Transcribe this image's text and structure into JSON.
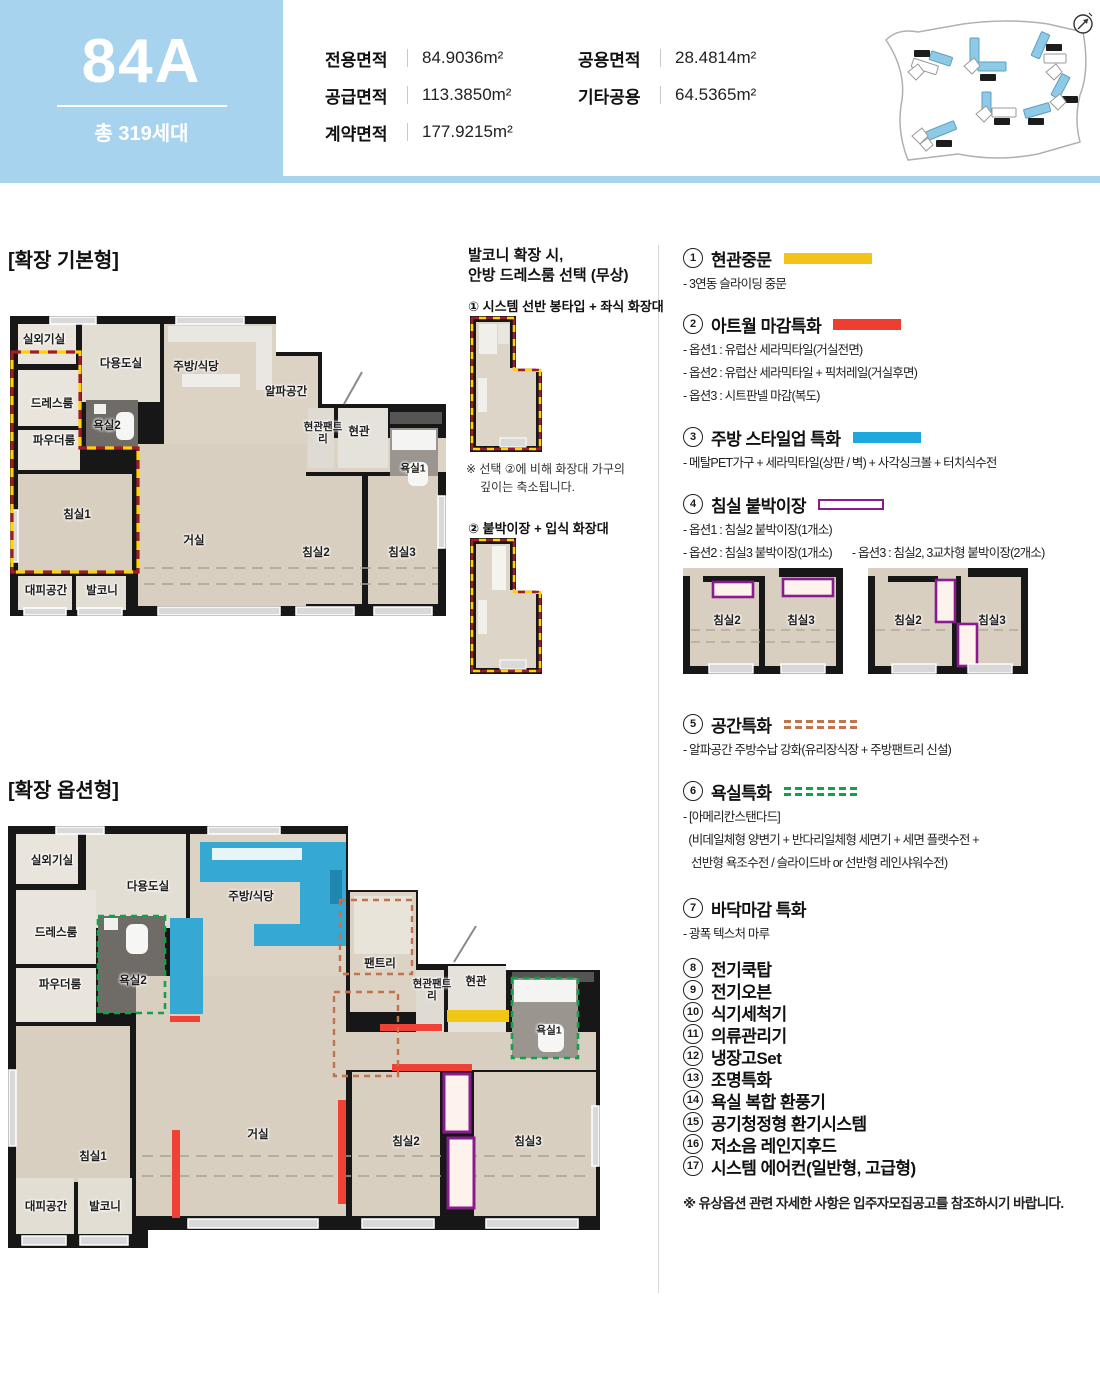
{
  "header": {
    "unit_type": "84A",
    "total_units": "총 319세대",
    "areas": [
      {
        "label": "전용면적",
        "value": "84.9036m²"
      },
      {
        "label": "공급면적",
        "value": "113.3850m²"
      },
      {
        "label": "계약면적",
        "value": "177.9215m²"
      },
      {
        "label": "공용면적",
        "value": "28.4814m²"
      },
      {
        "label": "기타공용",
        "value": "64.5365m²"
      }
    ]
  },
  "plans": {
    "basic": {
      "title": "[확장 기본형]",
      "rooms": [
        "실외기실",
        "다용도실",
        "주방/식당",
        "알파공간",
        "드레스룸",
        "욕실2",
        "파우더룸",
        "현관팬트리",
        "현관",
        "욕실1",
        "침실1",
        "거실",
        "침실2",
        "침실3",
        "대피공간",
        "발코니"
      ]
    },
    "option": {
      "title": "[확장 옵션형]",
      "rooms": [
        "실외기실",
        "다용도실",
        "주방/식당",
        "팬트리",
        "드레스룸",
        "욕실2",
        "파우더룸",
        "현관팬트리",
        "현관",
        "욕실1",
        "침실1",
        "거실",
        "침실2",
        "침실3",
        "대피공간",
        "발코니"
      ]
    }
  },
  "dressroom_choice": {
    "title_line1": "발코니 확장 시,",
    "title_line2": "안방 드레스룸 선택 (무상)",
    "option1": "① 시스템 선반 봉타입 + 좌식 화장대",
    "note_line1": "※ 선택 ②에 비해 화장대 가구의",
    "note_line2": "깊이는 축소됩니다.",
    "option2": "② 붙박이장 + 입식 화장대"
  },
  "features": {
    "items": [
      {
        "num": "1",
        "title": "현관중문",
        "legend": "yellow",
        "rows": [
          [
            "- 3연동 슬라이딩 중문"
          ]
        ]
      },
      {
        "num": "2",
        "title": "아트월 마감특화",
        "legend": "red",
        "rows": [
          [
            "- 옵션1 : 유럽산 세라믹타일(거실전면)"
          ],
          [
            "- 옵션2 : 유럽산 세라믹타일 + 픽처레일(거실후면)"
          ],
          [
            "- 옵션3 : 시트판넬 마감(복도)"
          ]
        ]
      },
      {
        "num": "3",
        "title": "주방 스타일업 특화",
        "legend": "blue",
        "rows": [
          [
            "- 메탈PET가구 + 세라믹타일(상판 / 벽) + 사각싱크볼 + 터치식수전"
          ]
        ]
      },
      {
        "num": "4",
        "title": "침실 붙박이장",
        "legend": "purple-outline",
        "rows": [
          [
            "- 옵션1 : 침실2 붙박이장(1개소)"
          ],
          [
            "- 옵션2 : 침실3 붙박이장(1개소)",
            "- 옵션3 : 침실2, 3교차형 붙박이장(2개소)"
          ]
        ]
      },
      {
        "num": "5",
        "title": "공간특화",
        "legend": "orange-dash",
        "rows": [
          [
            "- 알파공간 주방수납 강화(유리장식장 + 주방팬트리 신설)"
          ]
        ]
      },
      {
        "num": "6",
        "title": "욕실특화",
        "legend": "green-dash",
        "rows": [
          [
            "- [아메리칸스탠다드]"
          ],
          [
            "  (비데일체형 양변기 + 반다리일체형 세면기 + 세면 플랫수전 +"
          ],
          [
            "   선반형 욕조수전 / 슬라이드바 or 선반형 레인샤워수전)"
          ]
        ]
      },
      {
        "num": "7",
        "title": "바닥마감 특화",
        "legend": null,
        "rows": [
          [
            "- 광폭 텍스처 마루"
          ]
        ]
      },
      {
        "num": "8",
        "title": "전기쿡탑",
        "legend": null,
        "rows": []
      },
      {
        "num": "9",
        "title": "전기오븐",
        "legend": null,
        "rows": []
      },
      {
        "num": "10",
        "title": "식기세척기",
        "legend": null,
        "rows": []
      },
      {
        "num": "11",
        "title": "의류관리기",
        "legend": null,
        "rows": []
      },
      {
        "num": "12",
        "title": "냉장고Set",
        "legend": null,
        "rows": []
      },
      {
        "num": "13",
        "title": "조명특화",
        "legend": null,
        "rows": []
      },
      {
        "num": "14",
        "title": "욕실 복합 환풍기",
        "legend": null,
        "rows": []
      },
      {
        "num": "15",
        "title": "공기청정형 환기시스템",
        "legend": null,
        "rows": []
      },
      {
        "num": "16",
        "title": "저소음 레인지후드",
        "legend": null,
        "rows": []
      },
      {
        "num": "17",
        "title": "시스템 에어컨(일반형, 고급형)",
        "legend": null,
        "rows": []
      }
    ],
    "diagram": {
      "a": {
        "rooms": [
          "침실2",
          "침실3"
        ]
      },
      "b": {
        "rooms": [
          "침실2",
          "침실3"
        ]
      }
    },
    "footnote": "※ 유상옵션 관련 자세한 사항은 입주자모집공고를 참조하시기 바랍니다."
  },
  "colors": {
    "accent_blue": "#a7d3ef",
    "legend_yellow": "#f2c318",
    "legend_red": "#ee3e32",
    "legend_blue": "#1fa8de",
    "legend_purple": "#8a1b8f",
    "dash_orange": "#c0734d",
    "dash_green": "#12a14b"
  }
}
